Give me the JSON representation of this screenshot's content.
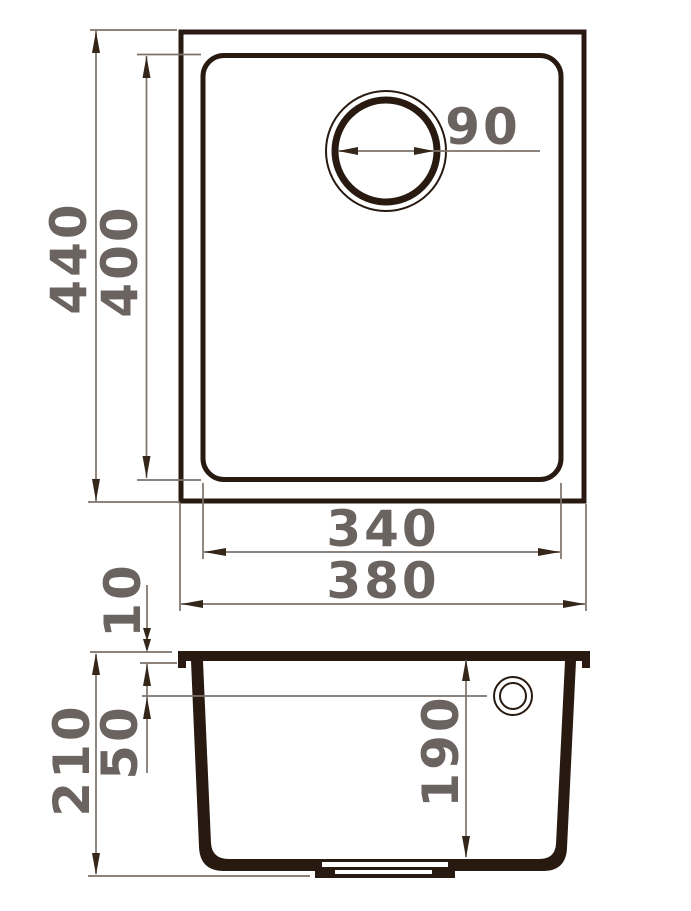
{
  "diagram": {
    "type": "sink-technical-drawing",
    "background": "#ffffff",
    "colors": {
      "outline": "#281a10",
      "dimension_line": "#7b726a",
      "dimension_text": "#6b6360"
    },
    "views": {
      "top_view": {
        "name": "top view (bowl with drain)",
        "dims": {
          "overall_height": "440",
          "bowl_height": "400",
          "drain_diameter": "90",
          "bowl_width": "340",
          "overall_width": "380"
        }
      },
      "side_view": {
        "name": "side section view (tub with overflow)",
        "dims": {
          "rim_thickness": "10",
          "overflow_level": "50",
          "total_height": "210",
          "bowl_depth": "190"
        }
      }
    },
    "dimensions": {
      "overall_height": "440",
      "bowl_height": "400",
      "drain_diameter": "90",
      "bowl_width": "340",
      "overall_width": "380",
      "rim_thickness": "10",
      "overflow_level": "50",
      "total_height": "210",
      "bowl_depth": "190"
    }
  }
}
